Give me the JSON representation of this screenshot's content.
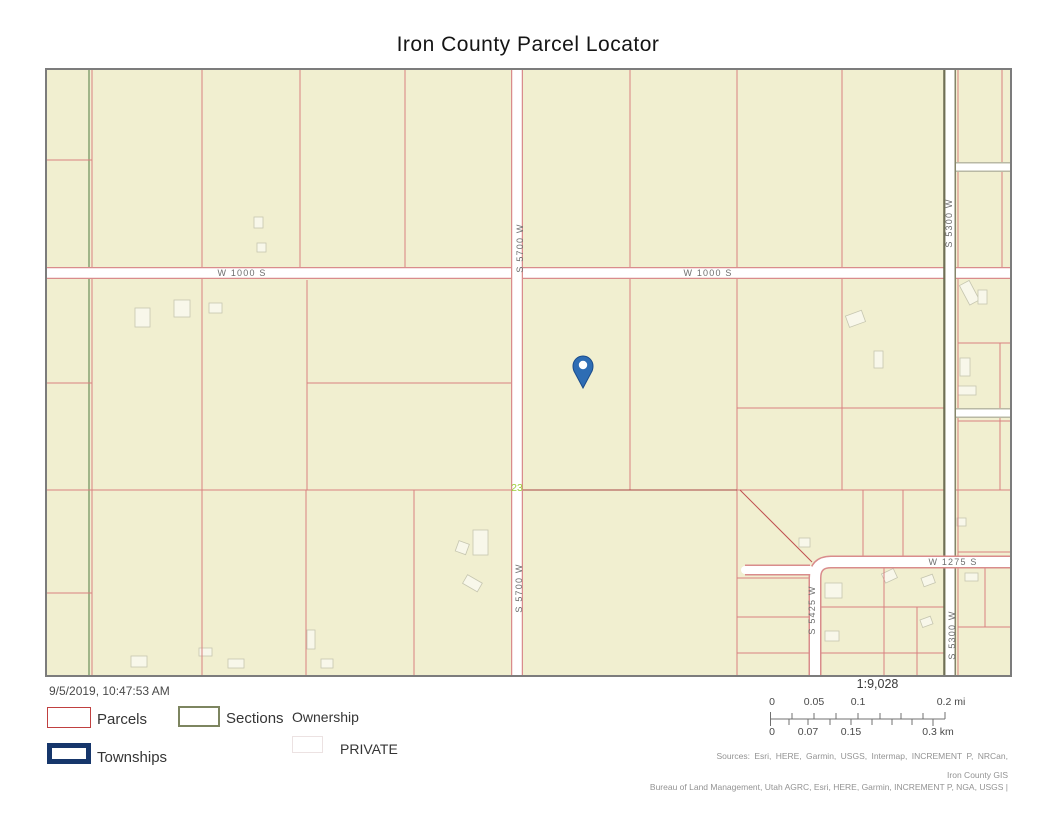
{
  "title": "Iron County Parcel Locator",
  "map": {
    "labels": {
      "w1000s_west": "W 1000 S",
      "w1000s_east": "W 1000 S",
      "s5700w_north": "S 5700 W",
      "s5700w_south": "S 5700 W",
      "s5300w_north": "S 5300 W",
      "s5300w_south": "S 5300 W",
      "s5425w": "S 5425 W",
      "w1275s": "W 1275 S",
      "section_number": "23"
    },
    "marker": "location-pin"
  },
  "timestamp": "9/5/2019, 10:47:53 AM",
  "legend": {
    "parcels_label": "Parcels",
    "sections_label": "Sections",
    "townships_label": "Townships",
    "ownership_title": "Ownership",
    "ownership_value": "PRIVATE"
  },
  "scalebar": {
    "ratio": "1:9,028",
    "mi_labels": [
      "0",
      "0.05",
      "0.1",
      "0.2 mi"
    ],
    "km_labels": [
      "0",
      "0.07",
      "0.15",
      "0.3 km"
    ]
  },
  "attribution": {
    "line1": "Sources: Esri, HERE, Garmin, USGS, Intermap, INCREMENT P, NRCan,",
    "line2": "Iron County GIS",
    "line3": "Bureau of Land Management, Utah AGRC, Esri, HERE, Garmin, INCREMENT P, NGA, USGS |"
  },
  "colors": {
    "map_background": "#f1efd0",
    "map_border": "#7c7c7c",
    "parcel_line": "#d98080",
    "parcel_line_dark": "#a84444",
    "section_line": "#4e7b41",
    "road_fill": "#ffffff",
    "road_casing_pink": "#d98c8c",
    "road_casing_olive": "#85856a",
    "road_label": "#6e6e6e",
    "marker_blue": "#2e6db4",
    "marker_border": "#1a4c8c",
    "section_number_green": "#9ccd39",
    "legend_parcels_swatch": "#c04040",
    "legend_sections_swatch": "#7d8560",
    "legend_townships_swatch": "#16366b"
  }
}
